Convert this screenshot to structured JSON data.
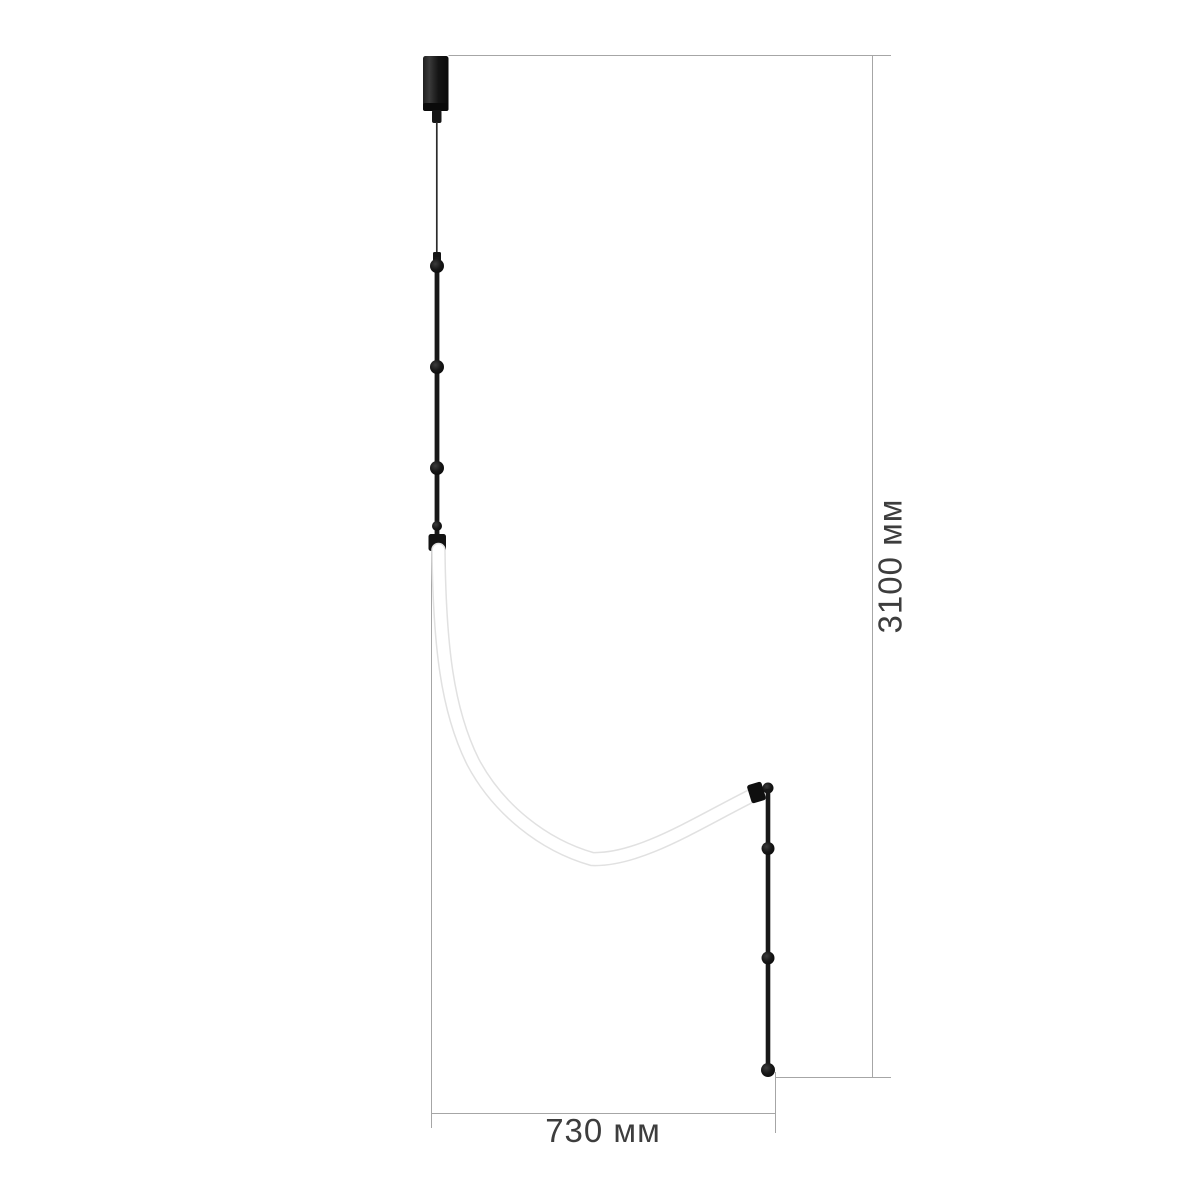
{
  "figure": {
    "name": "pendant-lamp-dimension-drawing",
    "parts": {
      "canopy": "ceiling-canopy-cylinder",
      "cable": "suspension-cable",
      "upper_rod": "upper-rod-with-beads",
      "tube": "curved-white-led-flex-tube",
      "clamp": "tube-end-clamp",
      "lower_rod": "lower-rod-with-beads"
    }
  },
  "dimensions": {
    "height": {
      "label": "3100 мм",
      "value_mm": 3100,
      "orientation": "vertical"
    },
    "width": {
      "label": "730 мм",
      "value_mm": 730,
      "orientation": "horizontal"
    }
  },
  "colors": {
    "background": "#ffffff",
    "dimension_line": "#a6a6a6",
    "dimension_text": "#3d3d3d",
    "lamp_black": "#141414",
    "lamp_black_light": "#2e2e2e",
    "cable": "#2b2b2b",
    "tube_edge": "#e1e1e1",
    "tube_fill": "#ffffff"
  }
}
